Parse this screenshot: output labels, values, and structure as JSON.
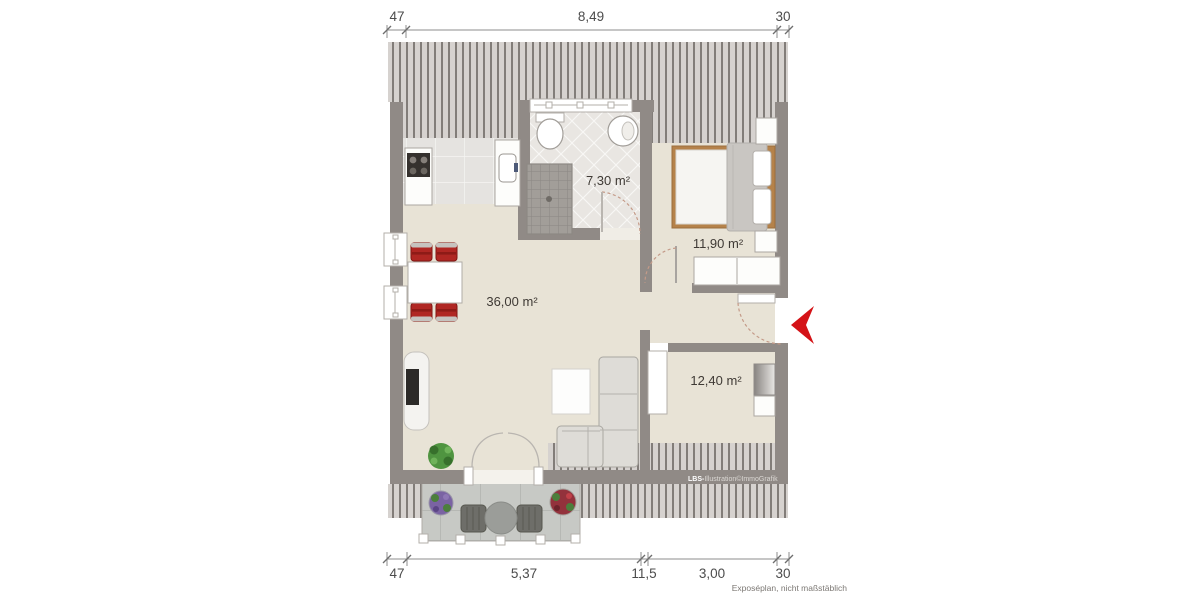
{
  "plan": {
    "rooms": {
      "living": {
        "label": "36,00 m²"
      },
      "bathroom": {
        "label": "7,30 m²"
      },
      "bedroom": {
        "label": "11,90 m²"
      },
      "room2": {
        "label": "12,40 m²"
      }
    },
    "dimensions_top": [
      "47",
      "8,49",
      "30"
    ],
    "dimensions_bottom": [
      "47",
      "5,37",
      "11,5",
      "3,00",
      "30"
    ],
    "footnote": "Exposéplan, nicht maßstäblich",
    "watermark": {
      "bold": "LBS-",
      "rest": "Illustration©ImmoGrafik"
    }
  },
  "colors": {
    "wall": "#908a86",
    "floor": "#e8e3d6",
    "hatch-bg": "#d6d2cf",
    "hatch-line": "#827d79",
    "accent-red": "#d41317",
    "chair-red": "#b02723",
    "bed-wood": "#b5824a",
    "dim-text": "#4c4c4c",
    "label-text": "#3f3a35"
  }
}
